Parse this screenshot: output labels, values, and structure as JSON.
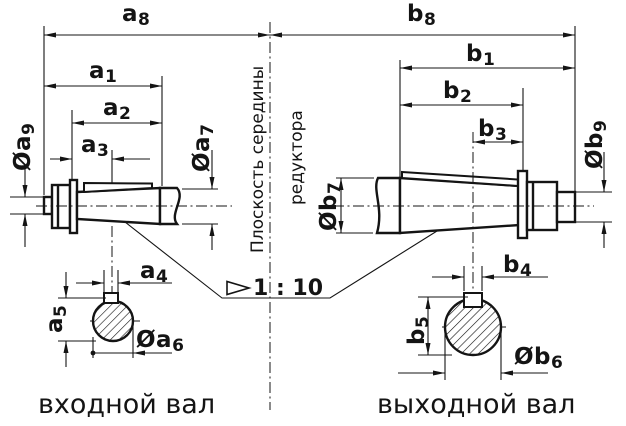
{
  "dims": {
    "a1": {
      "main": "a",
      "sub": "1"
    },
    "a2": {
      "main": "a",
      "sub": "2"
    },
    "a3": {
      "main": "a",
      "sub": "3"
    },
    "a4": {
      "main": "a",
      "sub": "4"
    },
    "a5": {
      "main": "a",
      "sub": "5"
    },
    "a6": {
      "main": "Øa",
      "sub": "6"
    },
    "a7": {
      "main": "Øa",
      "sub": "7"
    },
    "a8": {
      "main": "a",
      "sub": "8"
    },
    "a9": {
      "main": "Øa",
      "sub": "9"
    },
    "b1": {
      "main": "b",
      "sub": "1"
    },
    "b2": {
      "main": "b",
      "sub": "2"
    },
    "b3": {
      "main": "b",
      "sub": "3"
    },
    "b4": {
      "main": "b",
      "sub": "4"
    },
    "b5": {
      "main": "b",
      "sub": "5"
    },
    "b6": {
      "main": "Øb",
      "sub": "6"
    },
    "b7": {
      "main": "Øb",
      "sub": "7"
    },
    "b8": {
      "main": "b",
      "sub": "8"
    },
    "b9": {
      "main": "Øb",
      "sub": "9"
    }
  },
  "taper_label": "1 : 10",
  "center_plane": {
    "line1": "Плоскость середины",
    "line2": "редуктора"
  },
  "captions": {
    "input_shaft": "входной вал",
    "output_shaft": "выходной вал"
  },
  "colors": {
    "ink": "#141414",
    "bg": "#ffffff"
  }
}
